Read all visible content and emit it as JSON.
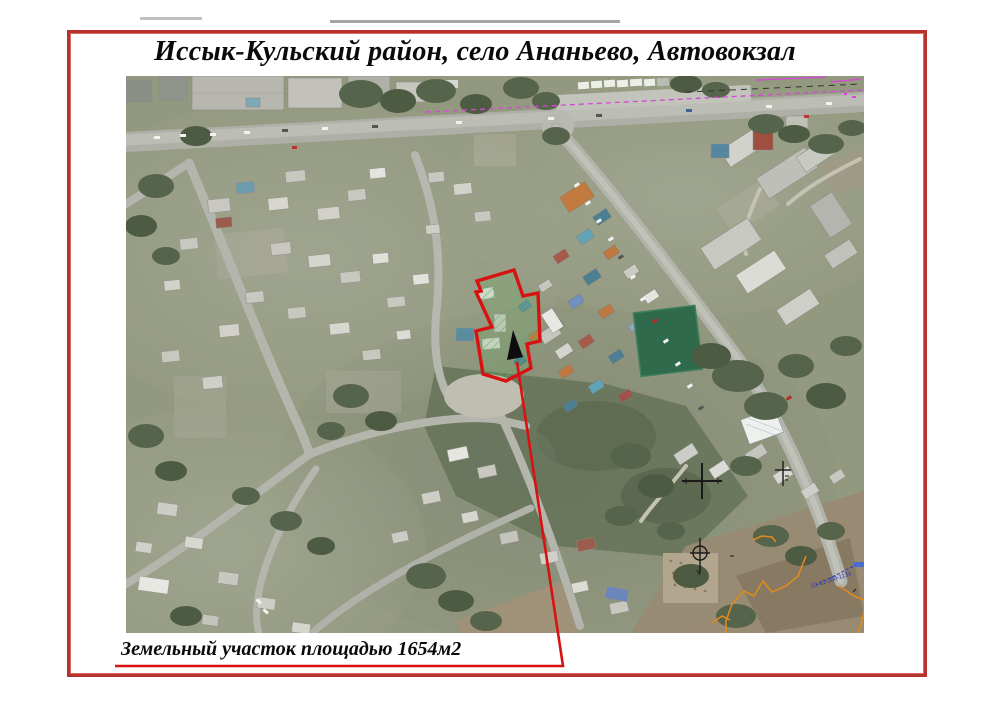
{
  "page": {
    "title": "Иссык-Кульский район, село Ананьево, Автовокзал",
    "caption": "Земельный участок площадью 1654м2",
    "frame_color": "#b5322e"
  },
  "map": {
    "kind": "satellite-photo",
    "cadastral_code": "03-11-100-1134",
    "colors": {
      "cadastral_magenta": "#d944d9",
      "boundary_orange": "#e08a1e",
      "cadastral_blue": "#2b35c0"
    }
  },
  "annotation": {
    "parcel_points": "514,270 477,281 481,291 476,292 492,327 476,331 483,374 506,381 531,368 527,344 540,341 538,293 523,296",
    "triangle_points": "513,330 507,360 523,357",
    "leader_points": "517,362 563,666 115,666",
    "outline_color": "#d81111",
    "hatch_color": "#5cb85c",
    "area_value": "1654м2"
  }
}
